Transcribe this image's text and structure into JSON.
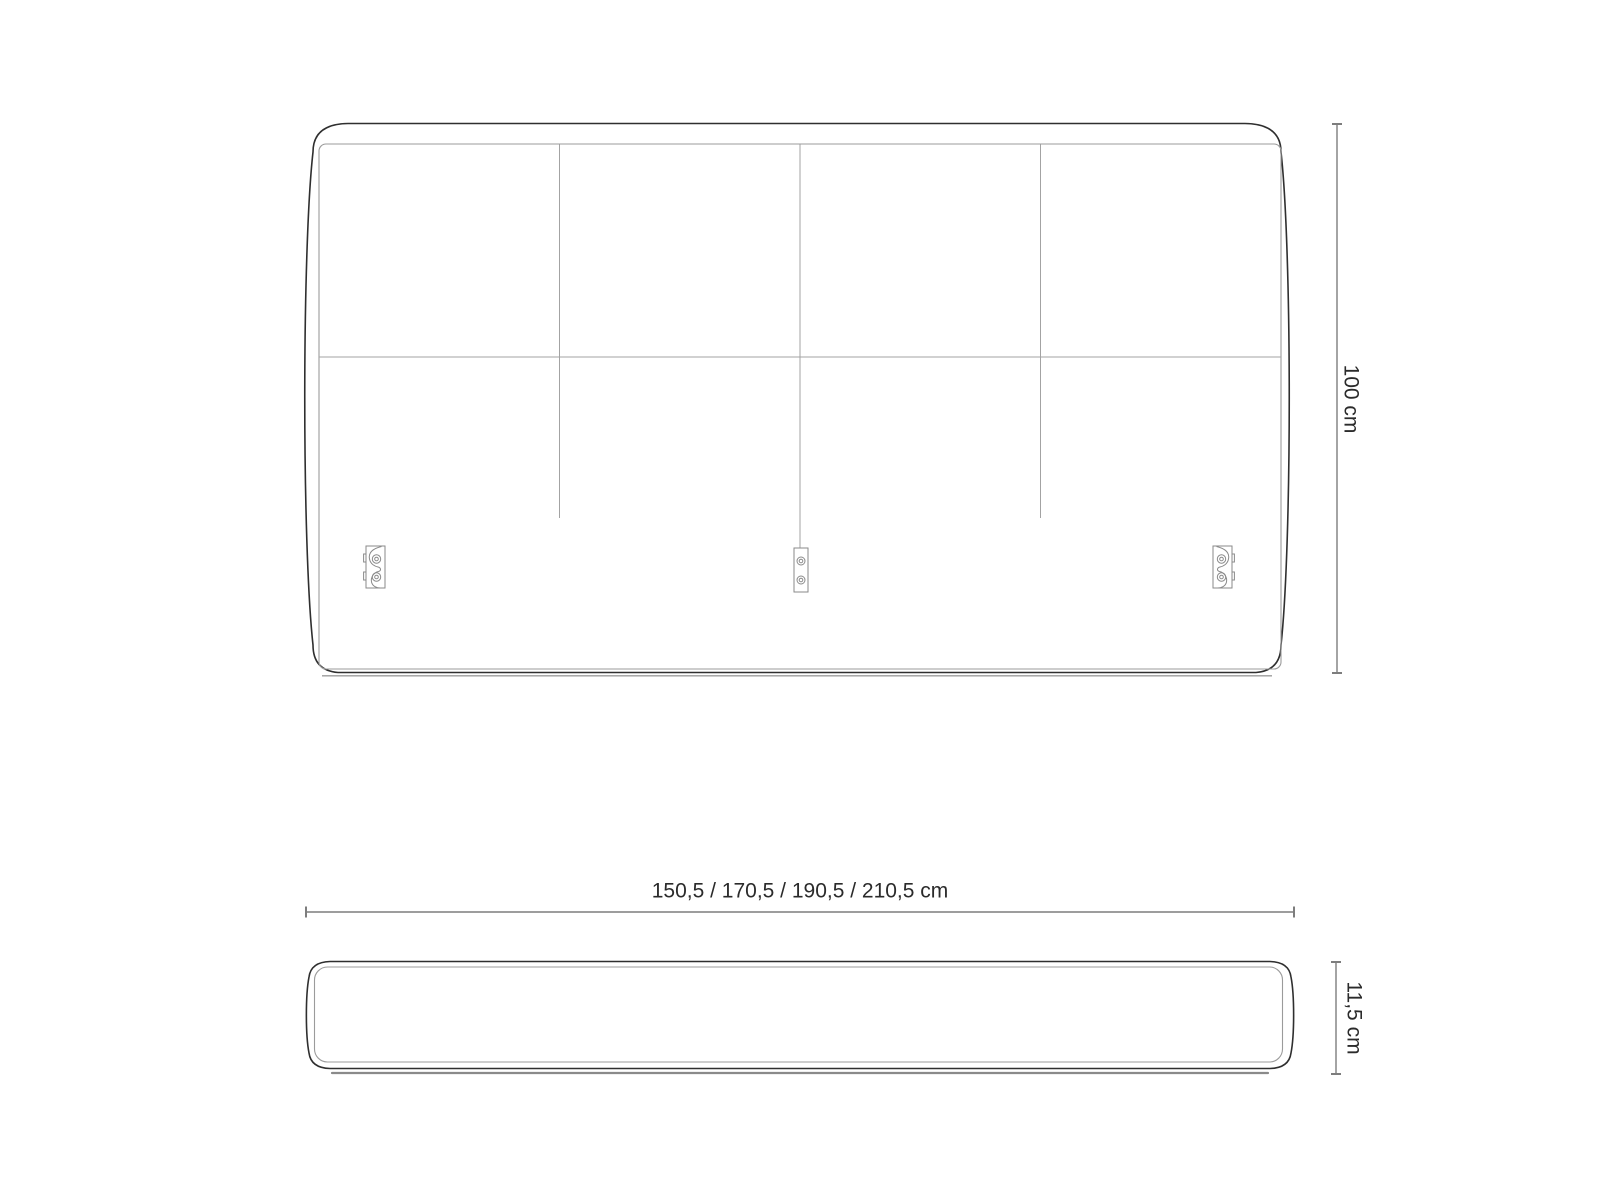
{
  "drawing": {
    "subject": "headboard",
    "front_view": {
      "panel_columns": 4,
      "panel_rows": 2,
      "mounting_brackets": 3
    },
    "top_view": {
      "shown": true
    }
  },
  "dimensions": {
    "height": {
      "label": "100 cm",
      "value_cm": "100"
    },
    "width": {
      "label": "150,5 / 170,5 / 190,5 / 210,5 cm",
      "options_cm": [
        "150,5",
        "170,5",
        "190,5",
        "210,5"
      ]
    },
    "depth": {
      "label": "11,5 cm",
      "value_cm": "11,5"
    }
  },
  "colors": {
    "outline_dark": "#2f2f2f",
    "line_gray": "#9b9b9b",
    "seam_gray": "#a3a3a3",
    "bracket_gray": "#8a8a8a",
    "dimension_gray": "#7d7d7d",
    "text": "#2b2b2b",
    "background": "#ffffff"
  }
}
